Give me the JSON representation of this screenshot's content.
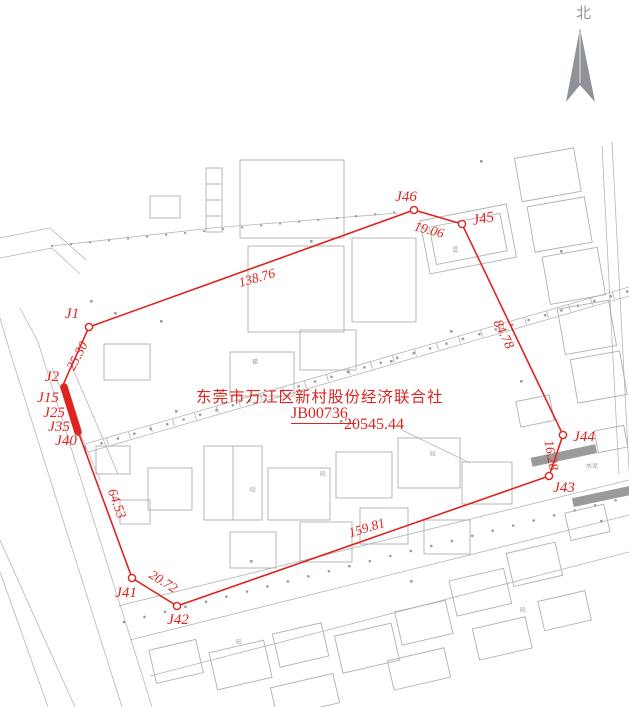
{
  "north": {
    "label": "北"
  },
  "colors": {
    "boundary": "#dd2420",
    "basemap": "#b3b3b3"
  },
  "title_block": {
    "owner": "东莞市万江区新村股份经济联合社",
    "parcel_id": "JB00736",
    "area": "20545.44"
  },
  "map": {
    "boundary_points": "89,327 414,210 462,224 563,435 549,476 177,606 132,578 79,434 63,385",
    "thick_segment": {
      "x1": 64,
      "y1": 387,
      "x2": 78,
      "y2": 432
    },
    "survey_points": [
      {
        "id": "J1",
        "x": 89,
        "y": 327,
        "marker": true,
        "lx": 72,
        "ly": 318
      },
      {
        "id": "J2",
        "x": 63,
        "y": 385,
        "marker": false,
        "lx": 52,
        "ly": 381
      },
      {
        "id": "J15",
        "x": 63,
        "y": 395,
        "marker": false,
        "lx": 48,
        "ly": 402
      },
      {
        "id": "J25",
        "x": 68,
        "y": 410,
        "marker": false,
        "lx": 54,
        "ly": 417
      },
      {
        "id": "J35",
        "x": 73,
        "y": 424,
        "marker": false,
        "lx": 59,
        "ly": 431
      },
      {
        "id": "J40",
        "x": 78,
        "y": 438,
        "marker": false,
        "lx": 66,
        "ly": 445
      },
      {
        "id": "J41",
        "x": 132,
        "y": 578,
        "marker": true,
        "lx": 126,
        "ly": 597
      },
      {
        "id": "J42",
        "x": 177,
        "y": 606,
        "marker": true,
        "lx": 178,
        "ly": 624
      },
      {
        "id": "J43",
        "x": 549,
        "y": 476,
        "marker": true,
        "lx": 564,
        "ly": 492
      },
      {
        "id": "J44",
        "x": 563,
        "y": 435,
        "marker": true,
        "lx": 584,
        "ly": 441
      },
      {
        "id": "J45",
        "x": 462,
        "y": 224,
        "marker": true,
        "lx": 484,
        "ly": 223,
        "rot": -10
      },
      {
        "id": "J46",
        "x": 414,
        "y": 210,
        "marker": true,
        "lx": 406,
        "ly": 201
      }
    ],
    "edge_labels": [
      {
        "text": "138.76",
        "x": 258,
        "y": 282,
        "rot": -16
      },
      {
        "text": "19.06",
        "x": 428,
        "y": 234,
        "rot": 15
      },
      {
        "text": "25.30",
        "x": 81,
        "y": 358,
        "rot": -62
      },
      {
        "text": "84.78",
        "x": 500,
        "y": 336,
        "rot": 64
      },
      {
        "text": "16.28",
        "x": 547,
        "y": 456,
        "rot": 80,
        "size": 10
      },
      {
        "text": "159.81",
        "x": 368,
        "y": 532,
        "rot": -17
      },
      {
        "text": "20.72",
        "x": 161,
        "y": 585,
        "rot": 32
      },
      {
        "text": "64.53",
        "x": 113,
        "y": 505,
        "rot": 70
      }
    ]
  }
}
